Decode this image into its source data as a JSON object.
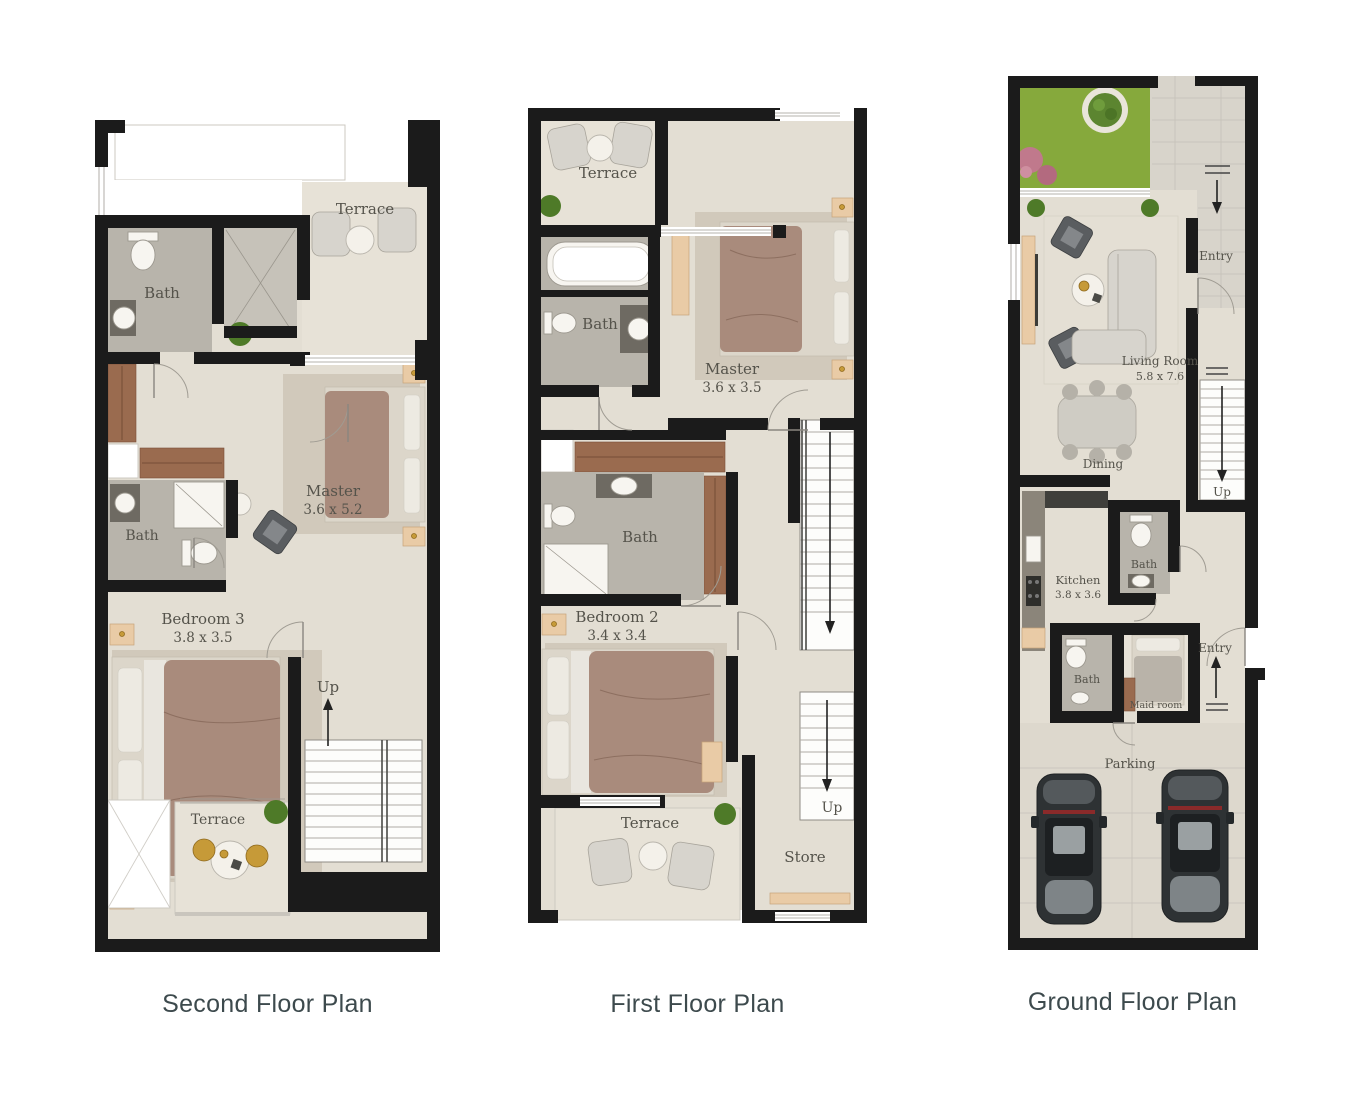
{
  "sheet": {
    "background": "#ffffff"
  },
  "colors": {
    "wall": "#1b1b1b",
    "floor": "#e3ded3",
    "bath_floor": "#b8b4ab",
    "grass": "#86a93c",
    "wood": "#9a6b4f",
    "gold": "#c69a38",
    "car_body": "#2e3234",
    "caption_text": "#3d4a4d",
    "room_label_text": "#55534b"
  },
  "plans": [
    {
      "id": "second-floor",
      "caption": "Second Floor Plan",
      "labels": {
        "terrace_top": "Terrace",
        "bath_top": "Bath",
        "master": "Master",
        "master_dim": "3.6 x 5.2",
        "bath_mid": "Bath",
        "bedroom": "Bedroom 3",
        "bedroom_dim": "3.8 x 3.5",
        "up": "Up",
        "terrace_bottom": "Terrace"
      }
    },
    {
      "id": "first-floor",
      "caption": "First Floor Plan",
      "labels": {
        "terrace_top": "Terrace",
        "bath_top": "Bath",
        "master": "Master",
        "master_dim": "3.6 x 3.5",
        "bath_mid": "Bath",
        "bedroom": "Bedroom 2",
        "bedroom_dim": "3.4 x 3.4",
        "terrace_bottom": "Terrace",
        "store": "Store",
        "up": "Up"
      }
    },
    {
      "id": "ground-floor",
      "caption": "Ground Floor Plan",
      "labels": {
        "entry_top": "Entry",
        "living": "Living Room",
        "living_dim": "5.8 x 7.6",
        "dining": "Dining",
        "up": "Up",
        "bath_upper": "Bath",
        "kitchen": "Kitchen",
        "kitchen_dim": "3.8 x 3.6",
        "bath_lower": "Bath",
        "maid": "Maid room",
        "entry_mid": "Entry",
        "parking": "Parking"
      }
    }
  ]
}
